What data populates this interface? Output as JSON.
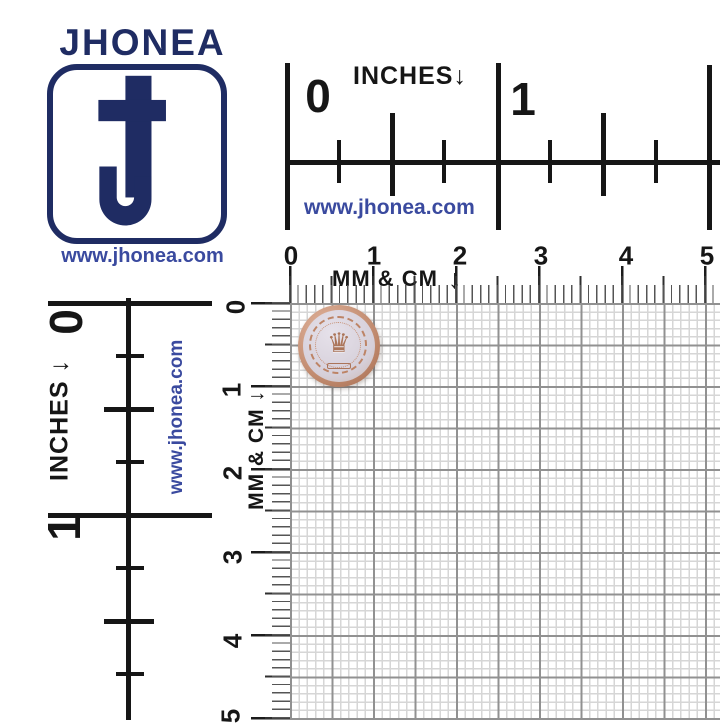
{
  "colors": {
    "navy": "#1f2c63",
    "link_blue": "#3a4a9f",
    "ruler_black": "#161616",
    "tick_gray": "#555555",
    "grid_fine": "#d6d6d6",
    "grid_heavy": "#919191",
    "button_copper": "#c08a6e",
    "button_face": "#d6d0da"
  },
  "logo": {
    "brand": "JHONEA",
    "website": "www.jhonea.com",
    "monogram": "J"
  },
  "top_inch_ruler": {
    "title": "INCHES",
    "arrow": "↓",
    "labels": [
      "0",
      "1"
    ],
    "website": "www.jhonea.com"
  },
  "left_inch_ruler": {
    "title": "INCHES ↓",
    "labels": [
      "0",
      "1"
    ],
    "website": "www.jhonea.com"
  },
  "top_mm_ruler": {
    "title": "MM & CM",
    "arrow": "↓",
    "numbers": [
      "0",
      "1",
      "2",
      "3",
      "4",
      "5"
    ]
  },
  "left_mm_ruler": {
    "title": "MM & CM ↓",
    "numbers": [
      "0",
      "1",
      "2",
      "3",
      "4",
      "5"
    ]
  },
  "product": {
    "description": "round copper metal button with embossed crown and laurel wreath",
    "crown_glyph": "♛"
  }
}
